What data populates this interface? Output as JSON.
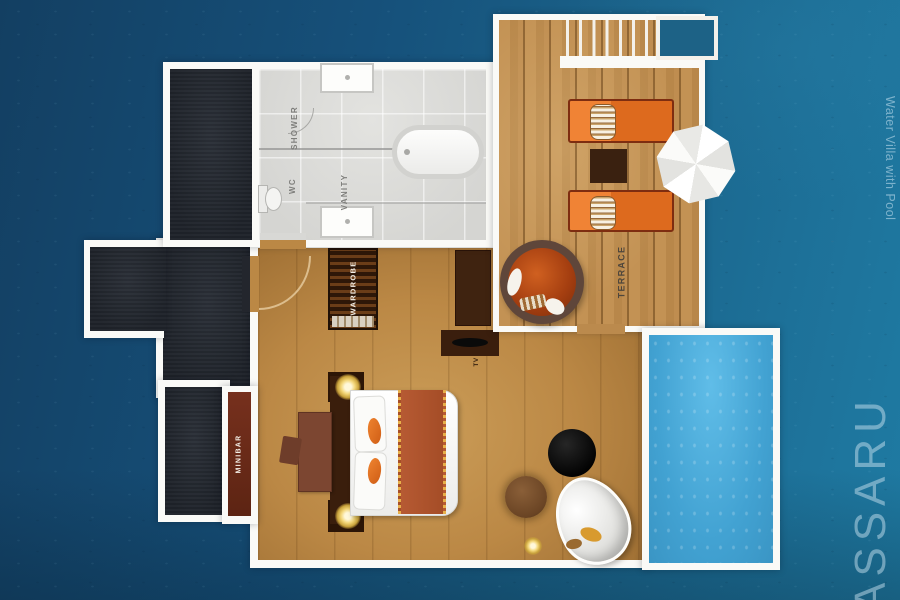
{
  "watermarks": {
    "villa_name": "Water Villa with Pool",
    "brand": "ASSARU"
  },
  "labels": {
    "shower": "SHOWER",
    "wc": "WC",
    "vanity": "VANITY",
    "wardrobe": "WARDROBE",
    "terrace": "TERRACE",
    "minibar": "MINIBAR",
    "tv": "TV"
  },
  "items": [
    "dark outdoor decks",
    "shower",
    "wc toilet",
    "vanity with two sinks",
    "bathtub",
    "stairs to lagoon",
    "water platform outline",
    "two sun loungers with towels",
    "side table",
    "white umbrella",
    "papasan chair",
    "wardrobe",
    "tv wall unit",
    "double bed with runner",
    "bedside lamps",
    "desk and chair",
    "minibar niche",
    "round black table",
    "pouf",
    "white egg lounger",
    "floor lamp",
    "private pool"
  ],
  "colors": {
    "ocean_dark": "#133f62",
    "ocean_light": "#1f7ba3",
    "pool": "#42a2d2",
    "wall_white": "#fafaf7",
    "terrace_wood": "#b8874a",
    "bedroom_wood": "#bb8845",
    "dark_deck": "#23262d",
    "lounger_orange": "#e4731f",
    "bed_runner": "#b65a33",
    "wardrobe_brown": "#3a2008"
  }
}
